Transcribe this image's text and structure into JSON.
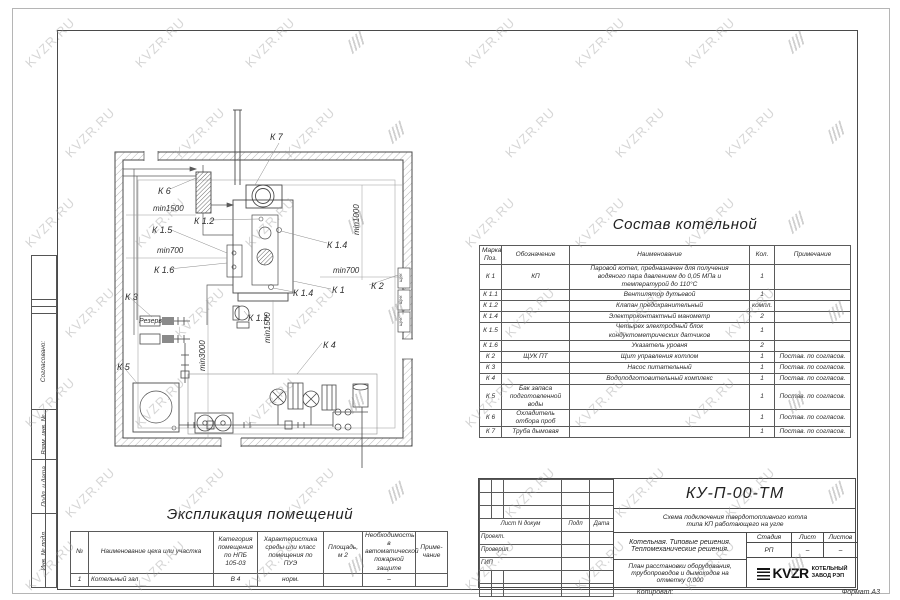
{
  "watermark": {
    "text": "KVZR.RU"
  },
  "stamp_left": {
    "agreed": "Согласовано:",
    "vzam": "Взам. инв. №",
    "podp": "Подп. и дата",
    "inv": "Инв. № подл."
  },
  "plan": {
    "labels": [
      "К 7",
      "К 6",
      "min1500",
      "К 1.5",
      "min700",
      "К 1.6",
      "К 3",
      "Резерв",
      "К 1.2",
      "К 1.4",
      "min700",
      "К 2",
      "К 1",
      "К 1.4",
      "К 1.1",
      "К 4",
      "К 5",
      "min1000",
      "min1500",
      "min3000"
    ],
    "panel_label": "ЩУК"
  },
  "sostav": {
    "title": "Состав котельной",
    "headers": {
      "mark": "Марка\nПоз.",
      "obozn": "Обозначение",
      "name": "Наименование",
      "qty": "Кол.",
      "note": "Примечание"
    },
    "rows": [
      {
        "mark": "К 1",
        "obozn": "КП",
        "name": "Паровой котел, предназначен для получения\nводяного пара давлением до 0,05 МПа и\nтемпературой до 110°С",
        "qty": "1",
        "note": ""
      },
      {
        "mark": "К 1.1",
        "obozn": "",
        "name": "Вентилятор дутьевой",
        "qty": "1",
        "note": ""
      },
      {
        "mark": "К 1.2",
        "obozn": "",
        "name": "Клапан предохранительный",
        "qty": "компл.",
        "note": ""
      },
      {
        "mark": "К 1.4",
        "obozn": "",
        "name": "Электроконтактный манометр",
        "qty": "2",
        "note": ""
      },
      {
        "mark": "К 1.5",
        "obozn": "",
        "name": "Четырех электродный блок\nкондуктометрических датчиков",
        "qty": "1",
        "note": ""
      },
      {
        "mark": "К 1.6",
        "obozn": "",
        "name": "Указатель уровня",
        "qty": "2",
        "note": ""
      },
      {
        "mark": "К 2",
        "obozn": "ЩУК ПТ",
        "name": "Щит управления котлом",
        "qty": "1",
        "note": "Постав. по согласов."
      },
      {
        "mark": "К 3",
        "obozn": "",
        "name": "Насос питательный",
        "qty": "1",
        "note": "Постав. по согласов."
      },
      {
        "mark": "К 4",
        "obozn": "",
        "name": "Водоподготовительный комплекс",
        "qty": "1",
        "note": "Постав. по согласов."
      },
      {
        "mark": "К 5",
        "obozn": "Бак запаса подготовленной\nводы",
        "name": "",
        "qty": "1",
        "note": "Постав. по согласов."
      },
      {
        "mark": "К 6",
        "obozn": "Охладитель отбора проб",
        "name": "",
        "qty": "1",
        "note": "Постав. по согласов."
      },
      {
        "mark": "К 7",
        "obozn": "Труба дымовая",
        "name": "",
        "qty": "1",
        "note": "Постав. по согласов."
      }
    ]
  },
  "explication": {
    "title": "Экспликация помещений",
    "headers": [
      "№",
      "Наименование цеха или участка",
      "Категория\nпомещения\nпо НПБ\n105-03",
      "Характеристика\nсреды или класс\nпомещения по\nПУЭ",
      "Площадь,\nм 2",
      "Необходимость в\nавтоматической\nпожарной защите",
      "Приме-\nчание"
    ],
    "row": [
      "1",
      "Котельный зал",
      "В 4",
      "норм.",
      "",
      "–",
      ""
    ]
  },
  "titleblock": {
    "doc_number": "КУ-П-00-ТМ",
    "doc_title": "Схема подключения твердотопливного котла\nтипа КП работающего на угле",
    "col_headers": {
      "list_ndoc": "Лист N докум",
      "podp": "Подп",
      "data": "Дата"
    },
    "roles": [
      "Проект.",
      "Проверил",
      "ГИП"
    ],
    "object": "Котельная. Типовые решения.\nТепломеханические решения.",
    "stage_headers": [
      "Стадия",
      "Лист",
      "Листов"
    ],
    "stage_values": [
      "РП",
      "–",
      "–"
    ],
    "sheet_title": "План расстановки оборудования,\nтрубопроводов и дымоходов на\nотметку 0,000",
    "logo": {
      "name": "KVZR",
      "org": "КОТЕЛЬНЫЙ\nЗАВОД РЭП"
    },
    "footer": {
      "copied": "Копировал:",
      "format": "Формат А3"
    }
  }
}
